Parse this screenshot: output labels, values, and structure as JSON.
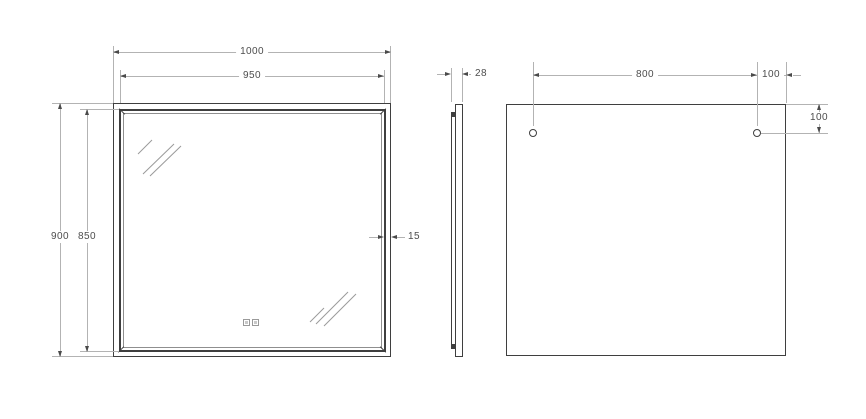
{
  "drawing": {
    "type": "mirror-dimension-diagram",
    "views": {
      "front": {
        "dim_width_outer": "1000",
        "dim_width_inner": "950",
        "dim_height_outer": "900",
        "dim_height_inner": "850",
        "dim_frame_width": "15"
      },
      "side": {
        "dim_depth": "28"
      },
      "back": {
        "dim_hole_spacing": "800",
        "dim_hole_side_offset": "100",
        "dim_hole_top_offset": "100"
      }
    },
    "colors": {
      "edge_line": "#3f3f3f",
      "dim_line": "#b3b3b3",
      "arrow": "#4a4a4a",
      "dim_text": "#4d4d4d",
      "background": "#ffffff"
    }
  }
}
